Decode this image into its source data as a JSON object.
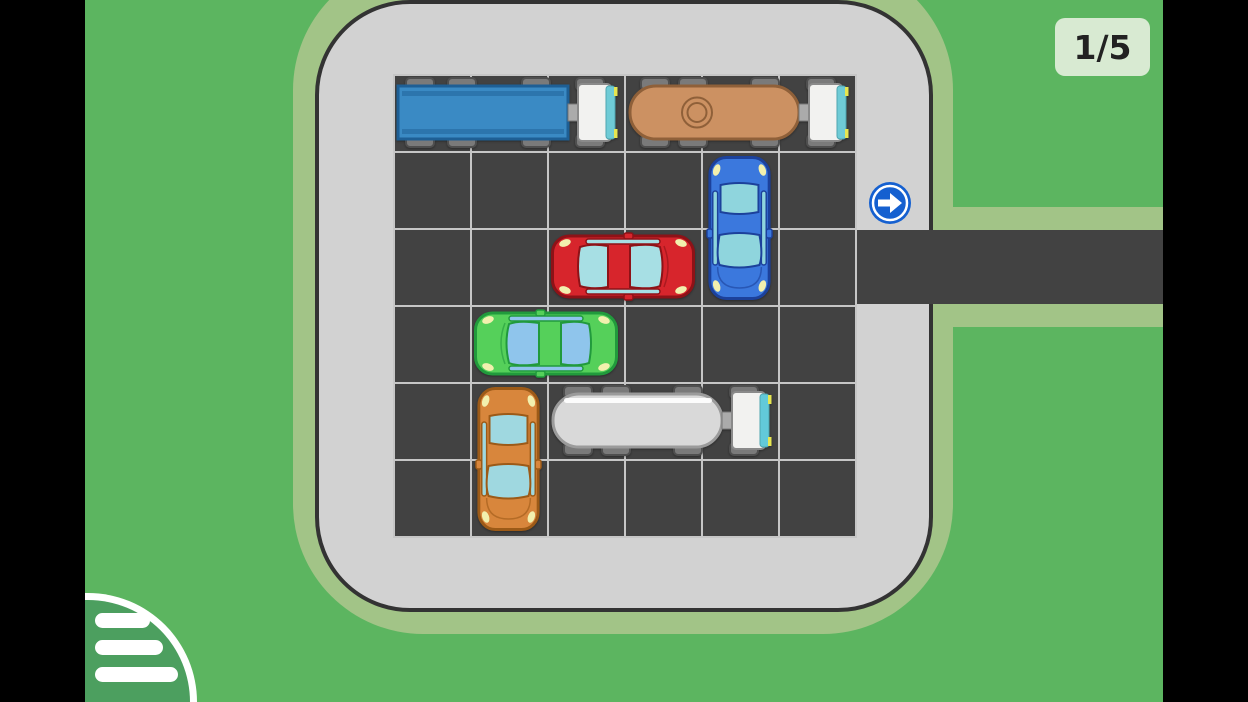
{
  "hud": {
    "level_badge": {
      "text": "1/5"
    },
    "menu_button": {
      "icon": "hamburger-list-icon",
      "bar_count": 3
    },
    "exit_sign": {
      "icon": "arrow-right-icon",
      "direction": "right"
    }
  },
  "board": {
    "rows": 6,
    "cols": 6,
    "exit_row": 2,
    "exit_side": "right",
    "vehicles": [
      {
        "id": "blue-truck",
        "type": "box-truck",
        "color": "blue",
        "row": 0,
        "col": 0,
        "length": 3,
        "orientation": "horizontal",
        "facing": "right",
        "colors": {
          "body": "#3a8ac4",
          "trim": "#1e5f95",
          "glass": "#6fcbd6"
        }
      },
      {
        "id": "tan-tanker",
        "type": "tanker-truck",
        "color": "tan",
        "row": 0,
        "col": 3,
        "length": 3,
        "orientation": "horizontal",
        "facing": "right",
        "colors": {
          "body": "#cc9162",
          "trim": "#8f6039",
          "glass": "#6fcbd6"
        }
      },
      {
        "id": "blue-car",
        "type": "car",
        "color": "blue",
        "row": 1,
        "col": 4,
        "length": 2,
        "orientation": "vertical",
        "facing": "down",
        "colors": {
          "body": "#3b78dd",
          "trim": "#1c419b",
          "glass": "#8fd5dd"
        }
      },
      {
        "id": "red-car",
        "type": "car",
        "color": "red",
        "row": 2,
        "col": 2,
        "length": 2,
        "orientation": "horizontal",
        "facing": "right",
        "colors": {
          "body": "#d7252c",
          "trim": "#8e1217",
          "glass": "#a7dfe4"
        }
      },
      {
        "id": "green-car",
        "type": "car",
        "color": "green",
        "row": 3,
        "col": 1,
        "length": 2,
        "orientation": "horizontal",
        "facing": "left",
        "colors": {
          "body": "#55d05a",
          "trim": "#219a3c",
          "glass": "#8fc5ec"
        }
      },
      {
        "id": "orange-car",
        "type": "car",
        "color": "orange",
        "row": 4,
        "col": 1,
        "length": 2,
        "orientation": "vertical",
        "facing": "down",
        "colors": {
          "body": "#d8863c",
          "trim": "#9c5a17",
          "glass": "#9fd8e0"
        }
      },
      {
        "id": "white-tanker",
        "type": "tanker-truck",
        "color": "white",
        "row": 4,
        "col": 2,
        "length": 3,
        "orientation": "horizontal",
        "facing": "right",
        "colors": {
          "body": "#d9d9d9",
          "trim": "#9b9b9b",
          "glass": "#62c9d9"
        }
      }
    ]
  },
  "colors": {
    "letterbox": "#000000",
    "grass": "#5cb560",
    "shoulder": "#a2c487",
    "parking_lot": "#d2d2d2",
    "lot_border": "#333333",
    "asphalt": "#424242",
    "grid_line": "#c6c6c6",
    "sign_blue": "#1560d0",
    "badge_bg": "#d8ead2",
    "badge_text": "#222222",
    "menu_green": "#4c9f5f",
    "cab_white": "#f2f2f0",
    "wheel_gray": "#7a7a7a",
    "headlight_yellow": "#f2f0ae"
  }
}
